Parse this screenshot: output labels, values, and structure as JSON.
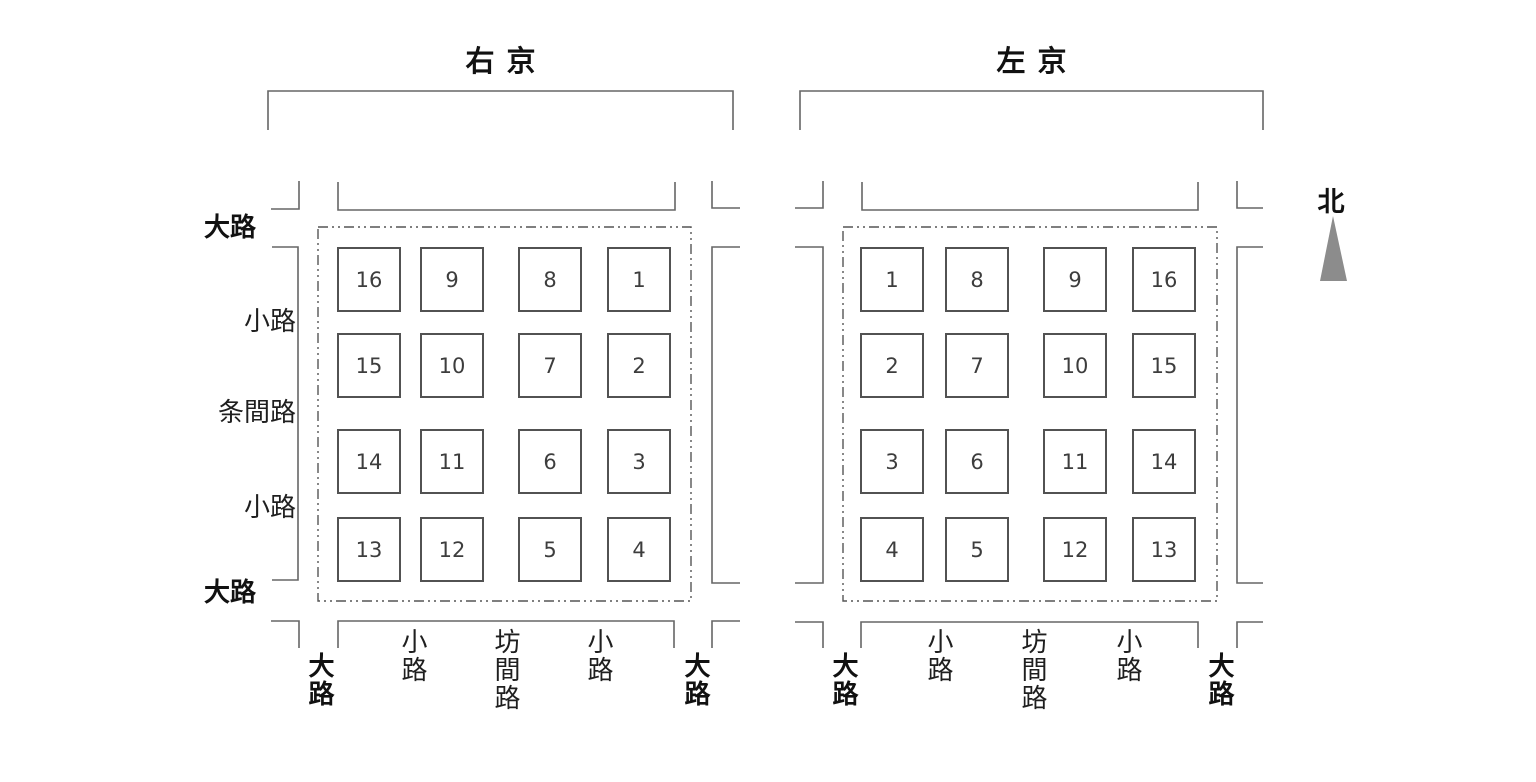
{
  "compass": {
    "label": "北"
  },
  "colors": {
    "line": "#666666",
    "boundary_dash": "#555555",
    "north_arrow": "#8c8c8c",
    "text": "#1a1a1a"
  },
  "left_road_labels": [
    "大路",
    "小路",
    "条間路",
    "小路",
    "大路"
  ],
  "grids": [
    {
      "title": "右京",
      "cells": [
        [
          16,
          9,
          8,
          1
        ],
        [
          15,
          10,
          7,
          2
        ],
        [
          14,
          11,
          6,
          3
        ],
        [
          13,
          12,
          5,
          4
        ]
      ],
      "bottom_road_labels": [
        "大路",
        "小路",
        "坊間路",
        "小路",
        "大路"
      ]
    },
    {
      "title": "左京",
      "cells": [
        [
          1,
          8,
          9,
          16
        ],
        [
          2,
          7,
          10,
          15
        ],
        [
          3,
          6,
          11,
          14
        ],
        [
          4,
          5,
          12,
          13
        ]
      ],
      "bottom_road_labels": [
        "大路",
        "小路",
        "坊間路",
        "小路",
        "大路"
      ]
    }
  ]
}
